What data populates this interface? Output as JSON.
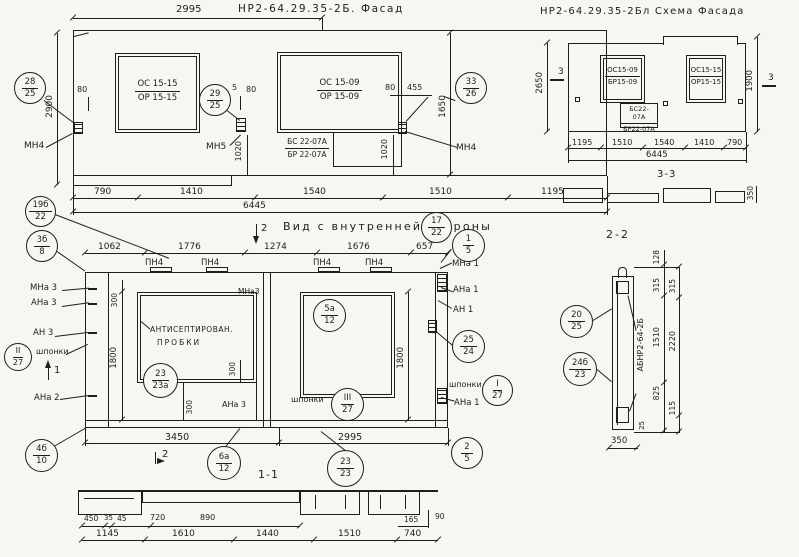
{
  "facade": {
    "title": "НР2-64.29.35-2Б. Фасад",
    "dim_top": "2995",
    "dim_h_left": "2900",
    "dim_h_right": "1650",
    "dim_80a": "80",
    "dim_5": "5",
    "dim_80b": "80",
    "dim_80c": "80",
    "dim_455": "455",
    "dim_1020a": "1020",
    "dim_1020b": "1020",
    "win_left_1": "ОС 15-15",
    "win_left_2": "ОР 15-15",
    "win_right_1": "ОС 15-09",
    "win_right_2": "ОР 15-09",
    "door_1": "БС 22-07А",
    "door_2": "БР 22-07А",
    "mn4_left": "МН4",
    "mn5": "МН5",
    "mn4_right": "МН4",
    "dims_bottom": [
      "790",
      "1410",
      "1540",
      "1510",
      "1195"
    ],
    "dim_total": "6445",
    "c28": {
      "t": "28",
      "b": "25"
    },
    "c29": {
      "t": "29",
      "b": "25"
    },
    "c33": {
      "t": "33",
      "b": "26"
    }
  },
  "scheme": {
    "title": "НР2-64.29.35-2Бл Схема Фасада",
    "dim_h_left": "2650",
    "dim_h_right": "1900",
    "mark3": "3",
    "win_left_1": "ОС15-09",
    "win_left_2": "БР15-09",
    "door_1": "БС22-07А",
    "door_2": "БР22-07А",
    "win_right_1": "ОС15-15",
    "win_right_2": "ОР15-15",
    "dims_bottom": [
      "1195",
      "1510",
      "1540",
      "1410",
      "790"
    ],
    "dim_total": "6445",
    "section33_title": "3-3",
    "dim_350": "350"
  },
  "inner": {
    "title": "Вид с внутренней стороны",
    "mark1": "1",
    "mark2": "2",
    "dims_top": [
      "1062",
      "1776",
      "1274",
      "1676",
      "657"
    ],
    "pn4": "ПН4",
    "dim_300": "300",
    "dim_1800": "1800",
    "note_1": "АНТИСЕПТИРОВАН.",
    "note_2": "ПРОБКИ",
    "shponki": "шпонки",
    "lbl_mna3": "МНа 3",
    "lbl_ana3": "АНа 3",
    "lbl_an3": "АН 3",
    "lbl_ana2": "АНа 2",
    "lbl_mna3_small": "МНа3",
    "lbl_mna1": "МНа 1",
    "lbl_ana1": "АНа 1",
    "lbl_an1": "АН 1",
    "dims_bottom": [
      "3450",
      "2995"
    ],
    "c19b": {
      "t": "19б",
      "b": "22"
    },
    "c3b": {
      "t": "3б",
      "b": "8"
    },
    "c17": {
      "t": "17",
      "b": "22"
    },
    "c1": {
      "t": "1",
      "b": "5"
    },
    "cII": {
      "t": "II",
      "b": "27"
    },
    "cI": {
      "t": "I",
      "b": "27"
    },
    "cIII": {
      "t": "III",
      "b": "27"
    },
    "c4b": {
      "t": "4б",
      "b": "10"
    },
    "c23a": {
      "t": "23",
      "b": "23а"
    },
    "c5a": {
      "t": "5а",
      "b": "12"
    },
    "c25": {
      "t": "25",
      "b": "24"
    },
    "c2": {
      "t": "2",
      "b": "5"
    },
    "c6a": {
      "t": "6а",
      "b": "12"
    },
    "c23": {
      "t": "23",
      "b": "23"
    }
  },
  "s11": {
    "title": "1-1",
    "dims_small": [
      "450",
      "35",
      "45",
      "720",
      "890",
      "165",
      "90"
    ],
    "dims_big": [
      "1145",
      "1610",
      "1440",
      "1510",
      "740"
    ]
  },
  "s22": {
    "title": "2-2",
    "mark_vertical": "АБНР2-64-2Б",
    "dim_128": "128",
    "dim_315a": "315",
    "dim_315b": "315",
    "dim_1510": "1510",
    "dim_2220": "2220",
    "dim_825": "825",
    "dim_115": "115",
    "dim_25": "25",
    "dim_350": "350",
    "c20": {
      "t": "20",
      "b": "25"
    },
    "c24b": {
      "t": "24б",
      "b": "23"
    }
  }
}
